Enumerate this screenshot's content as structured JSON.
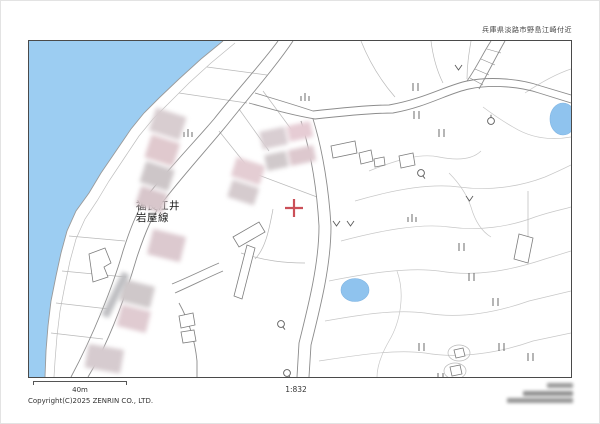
{
  "window": {
    "width": 600,
    "height": 424
  },
  "header": {
    "area_caption": "兵庫県淡路市野島江崎付近"
  },
  "map": {
    "road_label": {
      "line1": "福良江井",
      "line2": "岩屋線"
    },
    "marker": {
      "type": "red-cross",
      "color": "#cb4f58"
    },
    "colors": {
      "water": "#9ccdf2",
      "pond": "#8fc3ee",
      "road_line": "#8c8c8c",
      "lot_line": "#b9b9b9",
      "contour": "#c7c7c7",
      "building_line": "#7d7d7d",
      "frame": "#4a4a4a"
    },
    "symbols": {
      "rice_paddy": "||",
      "dry_field": "ılı",
      "crop_field": "v",
      "broadleaf_tree": "Q",
      "orchard_tree": "circle-with-stem"
    }
  },
  "footer": {
    "scale_bar_label": "40m",
    "scale_ratio": "1:832",
    "copyright": "Copyright(C)2025 ZENRIN CO., LTD."
  }
}
